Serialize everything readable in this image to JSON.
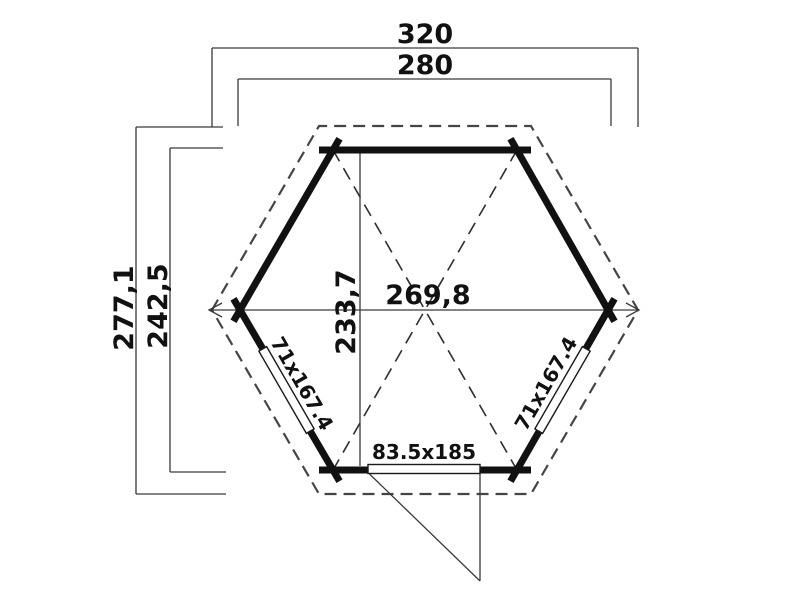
{
  "plan": {
    "type": "hexagonal-garden-building-floor-plan",
    "background_color": "#ffffff",
    "line_color": "#111111",
    "dimensions": {
      "overall_width": "320",
      "wall_outer_width": "280",
      "overall_depth": "277,1",
      "wall_outer_depth": "242,5",
      "internal_width": "269,8",
      "internal_depth": "233,7"
    },
    "openings": {
      "left_window": "71x167.4",
      "right_window": "71x167.4",
      "door": "83.5x185"
    }
  }
}
